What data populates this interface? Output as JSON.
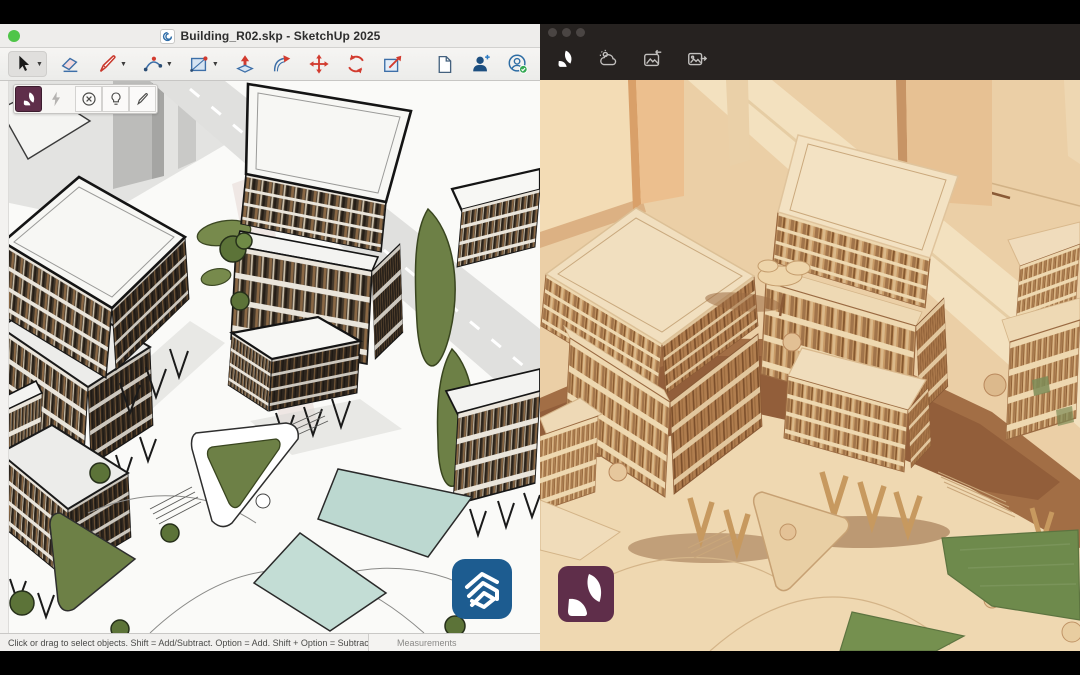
{
  "left_window": {
    "title_bar": {
      "title": "Building_R02.skp - SketchUp 2025",
      "app_icon": "sketchup-app-icon",
      "traffic_lights": [
        "green"
      ]
    },
    "toolbar": {
      "selected_tool": "select",
      "tools": [
        "select",
        "eraser",
        "line",
        "arc",
        "rectangle",
        "push-pull",
        "follow-me",
        "move",
        "rotate",
        "scale"
      ],
      "right_tools": [
        "new-document",
        "add-collaborator",
        "account"
      ]
    },
    "veras_toolbar": {
      "selected": "veras",
      "buttons": [
        "veras",
        "render-lightning",
        "cancel-render",
        "render-lightbulb",
        "sketch-pencil"
      ]
    },
    "status_bar": {
      "hint": "Click or drag to select objects. Shift = Add/Subtract. Option = Add. Shift + Option = Subtract.",
      "measurements_label": "Measurements"
    },
    "watermark": "sketchup-logo"
  },
  "right_window": {
    "traffic_lights": [
      "gray",
      "gray",
      "gray"
    ],
    "header_icons": [
      "veras-leaf",
      "environment-cloud",
      "render-image-in",
      "render-image-out"
    ],
    "watermark": "veras-logo"
  },
  "colors": {
    "titlebar_light": "#eeedeb",
    "titlebar_dark": "#262220",
    "sketchup_blue": "#1d5c90",
    "veras_maroon": "#5f2e4a",
    "tool_red": "#d23b2f",
    "tool_blue": "#3d6fa8",
    "render_wood": "#ebcfa6",
    "pool_teal": "#bcd8d0",
    "lawn_green": "#6e8a4c",
    "traffic_green": "#4fc548"
  }
}
